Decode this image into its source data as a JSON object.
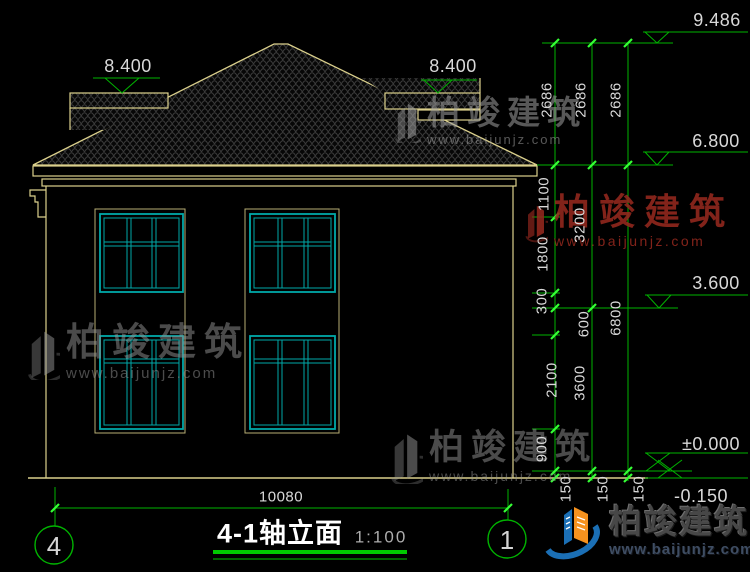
{
  "title_block": {
    "title": "4-1轴立面",
    "scale": "1:100"
  },
  "axes": {
    "left_bubble": "4",
    "right_bubble": "1"
  },
  "overall_width_dim": "10080",
  "levels": {
    "ridge": "9.486",
    "eave": "6.800",
    "left_wing_top": "8.400",
    "right_wing_top": "8.400",
    "second_floor": "3.600",
    "first_floor": "±0.000",
    "grade": "-0.150"
  },
  "dims": {
    "inner": [
      "2686",
      "1100",
      "1800",
      "300",
      "600",
      "2100",
      "900",
      "150"
    ],
    "middle": [
      "2686",
      "3200",
      "3600",
      "150"
    ],
    "outer": [
      "2686",
      "6800",
      "150"
    ]
  },
  "watermark": {
    "brand": "柏竣建筑",
    "url": "www.baijunjz.com"
  },
  "colors": {
    "linework": "#dbd08c",
    "window_frame": "#00a8a8",
    "dimension_green": "#00b400",
    "tick_green": "#35ff35",
    "dim_text": "#d9d9d9",
    "logo_blue": "#1b6fb5",
    "logo_orange": "#f6921e"
  }
}
